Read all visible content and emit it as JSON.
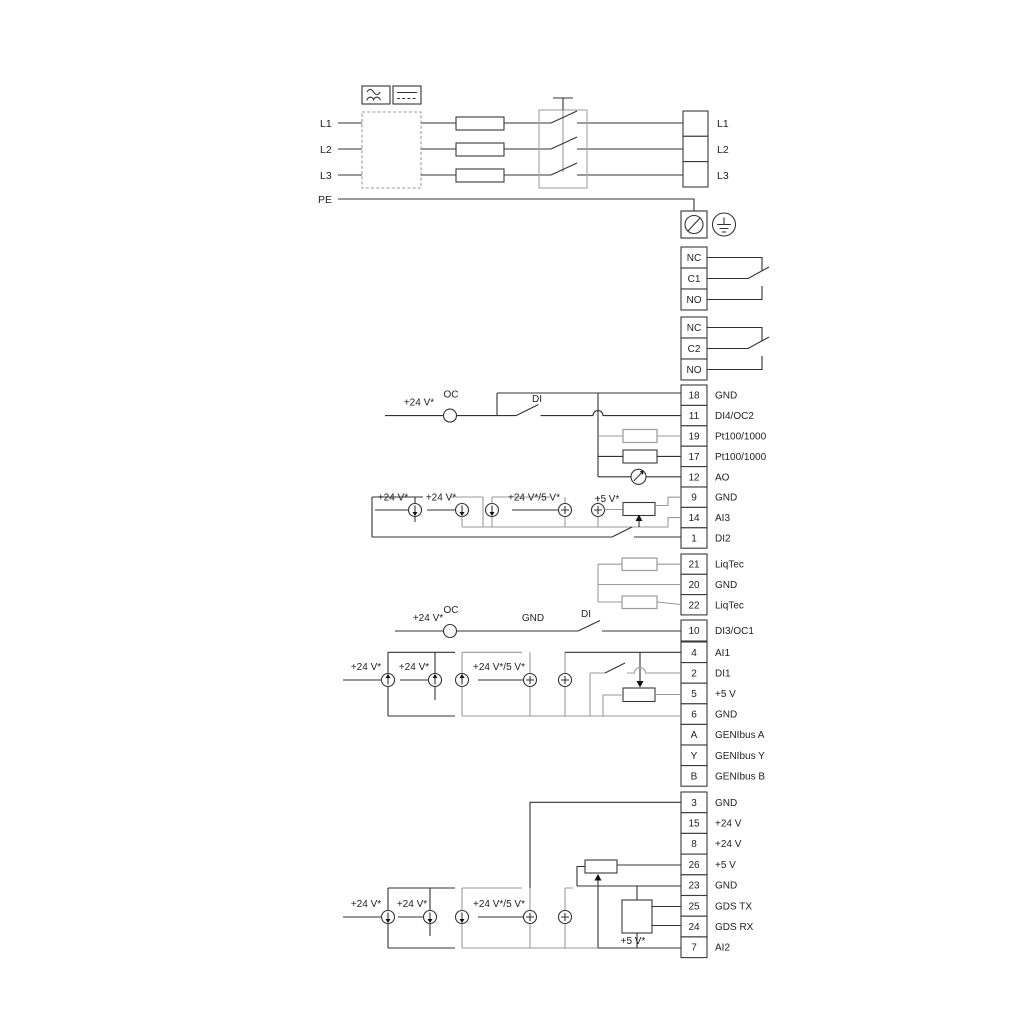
{
  "power": {
    "input_labels": [
      "L1",
      "L2",
      "L3",
      "PE"
    ],
    "terminal_labels": [
      "L1",
      "L2",
      "L3"
    ]
  },
  "relay1": {
    "rows": [
      "NC",
      "C1",
      "NO"
    ]
  },
  "relay2": {
    "rows": [
      "NC",
      "C2",
      "NO"
    ]
  },
  "io_top": {
    "rows": [
      {
        "num": "18",
        "label": "GND"
      },
      {
        "num": "11",
        "label": "DI4/OC2"
      },
      {
        "num": "19",
        "label": "Pt100/1000"
      },
      {
        "num": "17",
        "label": "Pt100/1000"
      },
      {
        "num": "12",
        "label": "AO"
      },
      {
        "num": "9",
        "label": "GND"
      },
      {
        "num": "14",
        "label": "AI3"
      },
      {
        "num": "1",
        "label": "DI2"
      }
    ]
  },
  "liqtec": {
    "rows": [
      {
        "num": "21",
        "label": "LiqTec"
      },
      {
        "num": "20",
        "label": "GND"
      },
      {
        "num": "22",
        "label": "LiqTec"
      }
    ]
  },
  "io_mid": {
    "rows": [
      {
        "num": "10",
        "label": "DI3/OC1"
      },
      {
        "num": "4",
        "label": "AI1"
      },
      {
        "num": "2",
        "label": "DI1"
      },
      {
        "num": "5",
        "label": "+5 V"
      },
      {
        "num": "6",
        "label": "GND"
      },
      {
        "num": "A",
        "label": "GENIbus A"
      },
      {
        "num": "Y",
        "label": "GENIbus Y"
      },
      {
        "num": "B",
        "label": "GENIbus B"
      }
    ]
  },
  "io_bottom": {
    "rows": [
      {
        "num": "3",
        "label": "GND"
      },
      {
        "num": "15",
        "label": "+24 V"
      },
      {
        "num": "8",
        "label": "+24 V"
      },
      {
        "num": "26",
        "label": "+5 V"
      },
      {
        "num": "23",
        "label": "GND"
      },
      {
        "num": "25",
        "label": "GDS TX"
      },
      {
        "num": "24",
        "label": "GDS RX"
      },
      {
        "num": "7",
        "label": "AI2"
      }
    ]
  },
  "annotations": {
    "v24": "+24 V*",
    "v24_5": "+24 V*/5 V*",
    "v5": "+5 V*",
    "oc": "OC",
    "di": "DI",
    "gnd": "GND"
  },
  "colors": {
    "wire": "#333333",
    "optional": "#9a9a9a"
  }
}
